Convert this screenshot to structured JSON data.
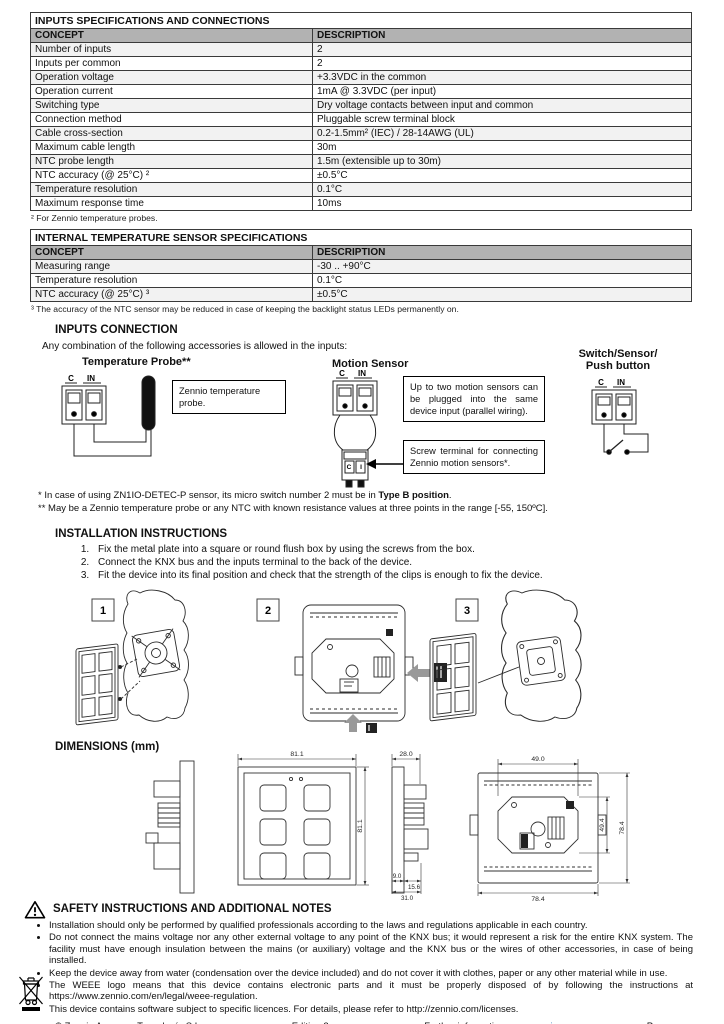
{
  "colors": {
    "table_header_bg": "#b2b2b2",
    "link_blue": "#2e75b6"
  },
  "terminal_labels": {
    "c": "C",
    "in": "IN",
    "i": "I"
  },
  "tables": [
    {
      "title": "INPUTS SPECIFICATIONS AND CONNECTIONS",
      "headers": [
        "CONCEPT",
        "DESCRIPTION"
      ],
      "rows": [
        [
          "Number of inputs",
          "2"
        ],
        [
          "Inputs per common",
          "2"
        ],
        [
          "Operation voltage",
          "+3.3VDC in the common"
        ],
        [
          "Operation current",
          "1mA @ 3.3VDC (per input)"
        ],
        [
          "Switching type",
          "Dry voltage contacts between input and common"
        ],
        [
          "Connection method",
          "Pluggable screw terminal block"
        ],
        [
          "Cable cross-section",
          "0.2-1.5mm² (IEC) / 28-14AWG (UL)"
        ],
        [
          "Maximum cable length",
          "30m"
        ],
        [
          "NTC probe length",
          "1.5m (extensible up to 30m)"
        ],
        [
          "NTC accuracy (@ 25°C) ²",
          "±0.5°C"
        ],
        [
          "Temperature resolution",
          "0.1°C"
        ],
        [
          "Maximum response time",
          "10ms"
        ]
      ],
      "footnote": "² For Zennio temperature probes."
    },
    {
      "title": "INTERNAL TEMPERATURE SENSOR SPECIFICATIONS",
      "headers": [
        "CONCEPT",
        "DESCRIPTION"
      ],
      "rows": [
        [
          "Measuring range",
          "-30 .. +90°C"
        ],
        [
          "Temperature resolution",
          "0.1°C"
        ],
        [
          "NTC accuracy (@ 25°C) ³",
          "±0.5°C"
        ]
      ],
      "footnote": "³ The accuracy of the NTC sensor may be reduced in case of keeping the backlight status LEDs permanently on."
    }
  ],
  "inputs_connection": {
    "heading": "INPUTS CONNECTION",
    "intro": "Any combination of the following accessories is allowed in the inputs:",
    "temperature_probe": {
      "title": "Temperature Probe**",
      "note": "Zennio temperature probe."
    },
    "motion_sensor": {
      "title": "Motion Sensor",
      "note_top": "Up to two motion sensors can be plugged into the same device input (parallel wiring).",
      "note_bottom": "Screw terminal for connecting Zennio motion sensors*."
    },
    "switch": {
      "title_line1": "Switch/Sensor/",
      "title_line2": "Push button"
    },
    "footnote1_prefix": "* In case of using ZN1IO-DETEC-P sensor, its micro switch number 2 must be in ",
    "footnote1_bold": "Type B position",
    "footnote1_suffix": ".",
    "footnote2": "** May be a Zennio temperature probe or any NTC with known resistance values at three points in the range [-55, 150ºC]."
  },
  "installation": {
    "heading": "INSTALLATION INSTRUCTIONS",
    "steps": [
      "Fix the metal plate into a square or round flush box by using the screws from the box.",
      "Connect the KNX bus and the inputs terminal to the back of the device.",
      "Fit the device into its final position and check that the strength of the clips is enough to fix the device."
    ],
    "figures": [
      "1",
      "2",
      "3"
    ]
  },
  "dimensions": {
    "heading": "DIMENSIONS (mm)",
    "front_width": "81.1",
    "front_height": "81.1",
    "side_depth": "28.0",
    "side_bezel": "9.0",
    "side_body": "15.6",
    "side_total": "31.0",
    "back_plate_width": "49.0",
    "back_plate_height": "49.4",
    "back_height": "78.4",
    "back_width": "78.4"
  },
  "safety": {
    "heading": "SAFETY INSTRUCTIONS AND ADDITIONAL NOTES",
    "bullets": [
      "Installation should only be performed by qualified professionals according to the laws and regulations applicable in each country.",
      "Do not connect the mains voltage nor any other external voltage to any point of the KNX bus; it would represent a risk for the entire KNX system. The facility must have enough insulation between the mains (or auxiliary) voltage and the KNX bus or the wires of other accessories, in case of being installed.",
      "Keep the device away from water (condensation over the device included) and do not cover it with clothes, paper or any other material while in use.",
      "The WEEE logo means that this device contains electronic parts and it must be properly disposed of by following the instructions at https://www.zennio.com/en/legal/weee-regulation.",
      "This device contains software subject to specific licences. For details, please refer to http://zennio.com/licenses."
    ]
  },
  "footer": {
    "copyright": "© Zennio Avance y Tecnología S.L.",
    "edition": "Edition 2",
    "further_prefix": "Further information ",
    "further_link": "www.zennio.com",
    "page": "Page 2/2"
  }
}
